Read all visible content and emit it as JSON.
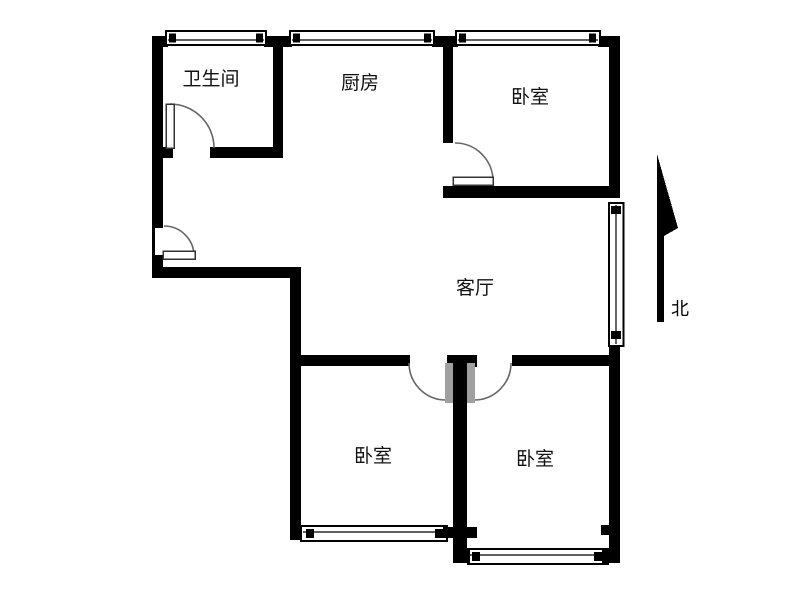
{
  "page": {
    "background": "#ffffff",
    "wall_color": "#000000",
    "door_arc_color": "#666666",
    "door_leaf_color": "#a0a0a0"
  },
  "rooms": [
    {
      "id": "bathroom",
      "label": "卫生间"
    },
    {
      "id": "kitchen",
      "label": "厨房"
    },
    {
      "id": "bedroom-northeast",
      "label": "卧室"
    },
    {
      "id": "living-room",
      "label": "客厅"
    },
    {
      "id": "bedroom-southwest",
      "label": "卧室"
    },
    {
      "id": "bedroom-southeast",
      "label": "卧室"
    }
  ],
  "compass": {
    "label": "北"
  }
}
